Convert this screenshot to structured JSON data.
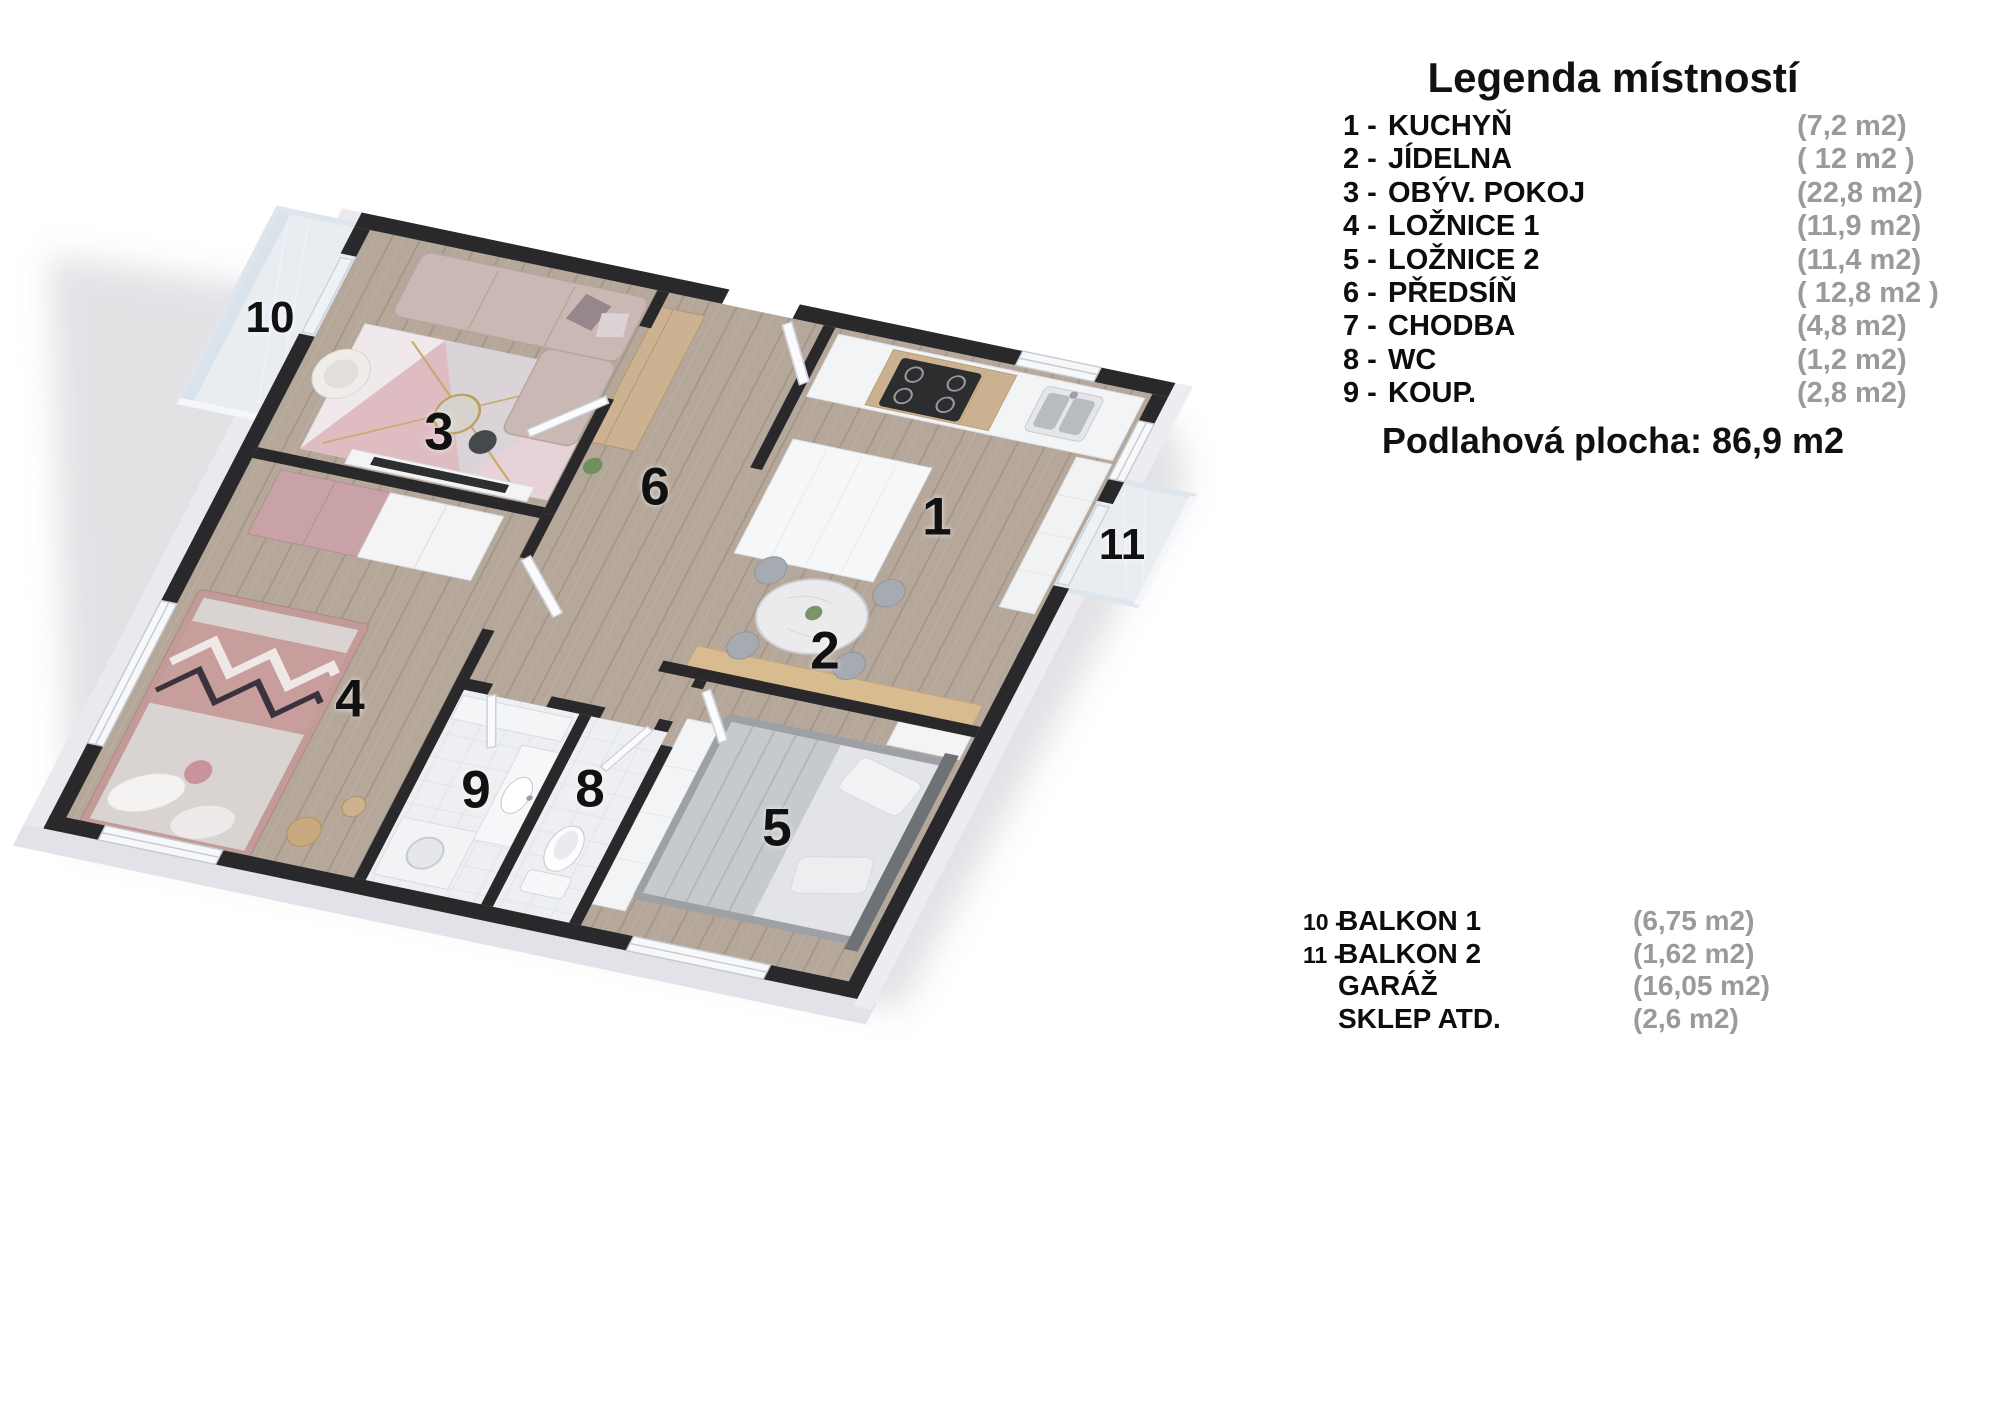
{
  "floor_plan": {
    "labels": [
      {
        "text": "10"
      },
      {
        "text": "3"
      },
      {
        "text": "6"
      },
      {
        "text": "1"
      },
      {
        "text": "11"
      },
      {
        "text": "2"
      },
      {
        "text": "4"
      },
      {
        "text": "9"
      },
      {
        "text": "8"
      },
      {
        "text": "5"
      }
    ]
  },
  "legend": {
    "title": "Legenda místností",
    "rooms": [
      {
        "num": "1 -",
        "label": "KUCHYŇ",
        "area": "(7,2 m2)"
      },
      {
        "num": "2 -",
        "label": "JÍDELNA",
        "area": "( 12 m2 )"
      },
      {
        "num": "3 -",
        "label": "OBÝV. POKOJ",
        "area": "(22,8 m2)"
      },
      {
        "num": "4 -",
        "label": "LOŽNICE 1",
        "area": "(11,9 m2)"
      },
      {
        "num": "5 -",
        "label": "LOŽNICE 2",
        "area": "(11,4 m2)"
      },
      {
        "num": "6 -",
        "label": "PŘEDSÍŇ",
        "area": "( 12,8 m2 )"
      },
      {
        "num": "7 -",
        "label": "CHODBA",
        "area": "(4,8 m2)"
      },
      {
        "num": "8 -",
        "label": "WC",
        "area": "(1,2 m2)"
      },
      {
        "num": "9 -",
        "label": "KOUP.",
        "area": "(2,8 m2)"
      }
    ],
    "total": "Podlahová plocha: 86,9 m2",
    "extras": [
      {
        "num": "10 -",
        "label": "BALKON 1",
        "area": "(6,75 m2)"
      },
      {
        "num": "11 -",
        "label": "BALKON 2",
        "area": "(1,62 m2)"
      },
      {
        "num": "",
        "label": "GARÁŽ",
        "area": "(16,05 m2)"
      },
      {
        "num": "",
        "label": "SKLEP ATD.",
        "area": "(2,6 m2)"
      }
    ]
  },
  "colors": {
    "wall_dark": "#29292b",
    "floor_wood": "#b5a79a",
    "area_text": "#9a9a9a",
    "label_text": "#111111"
  }
}
